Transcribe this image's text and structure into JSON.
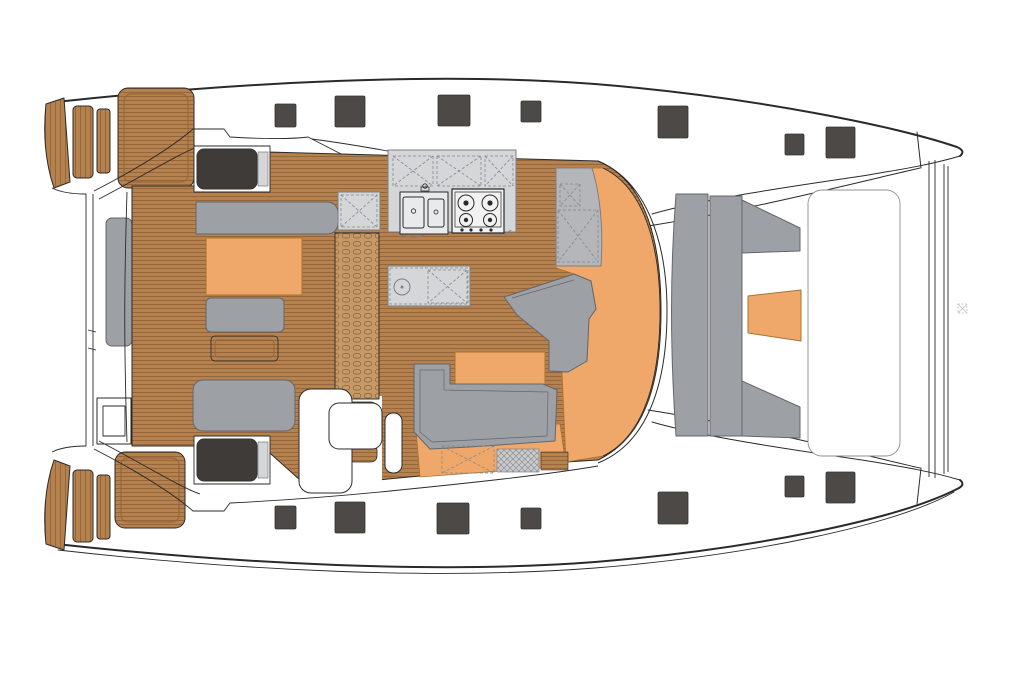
{
  "diagram": {
    "type": "deck-plan",
    "subject": "sailing-catamaran-main-deck",
    "orientation": "bow-right"
  },
  "colors": {
    "outline": "#2a2a2a",
    "line_light": "#8f8f8f",
    "deck_white": "#ffffff",
    "teak": "#b5814e",
    "teak_stripe": "#8f6036",
    "teak_light": "#c59a67",
    "orange": "#efa86a",
    "orange_stroke": "#a9732f",
    "bench_gray": "#9da0a5",
    "bench_stroke": "#64666b",
    "counter_gray": "#d5d6d8",
    "counter_stroke": "#7d7f83",
    "cabinet_gray": "#b4b6ba",
    "dash_line": "#85878c",
    "crosshatch_gray": "#c8c9cb",
    "hatch_dark": "#4d4946",
    "hatch_stroke": "#35322f",
    "module_dark": "#3e3b39",
    "sink_white": "#e9eaeb",
    "stove_white": "#f2f2f2",
    "watermark_gray": "#bfbfbf"
  },
  "deck_hatches": [
    {
      "x": 275,
      "y": 104,
      "w": 21,
      "h": 23
    },
    {
      "x": 335,
      "y": 96,
      "w": 30,
      "h": 31
    },
    {
      "x": 438,
      "y": 95,
      "w": 32,
      "h": 31
    },
    {
      "x": 521,
      "y": 101,
      "w": 20,
      "h": 21
    },
    {
      "x": 658,
      "y": 106,
      "w": 30,
      "h": 32
    },
    {
      "x": 785,
      "y": 134,
      "w": 19,
      "h": 21
    },
    {
      "x": 826,
      "y": 127,
      "w": 29,
      "h": 31
    },
    {
      "x": 275,
      "y": 506,
      "w": 21,
      "h": 23
    },
    {
      "x": 335,
      "y": 502,
      "w": 30,
      "h": 31
    },
    {
      "x": 437,
      "y": 503,
      "w": 32,
      "h": 31
    },
    {
      "x": 521,
      "y": 508,
      "w": 20,
      "h": 21
    },
    {
      "x": 658,
      "y": 492,
      "w": 30,
      "h": 32
    },
    {
      "x": 785,
      "y": 476,
      "w": 19,
      "h": 21
    },
    {
      "x": 826,
      "y": 472,
      "w": 29,
      "h": 31
    }
  ],
  "watermark": {
    "x": 958,
    "y": 304
  },
  "galley": {
    "burners": 4,
    "sink_basins": 2
  }
}
